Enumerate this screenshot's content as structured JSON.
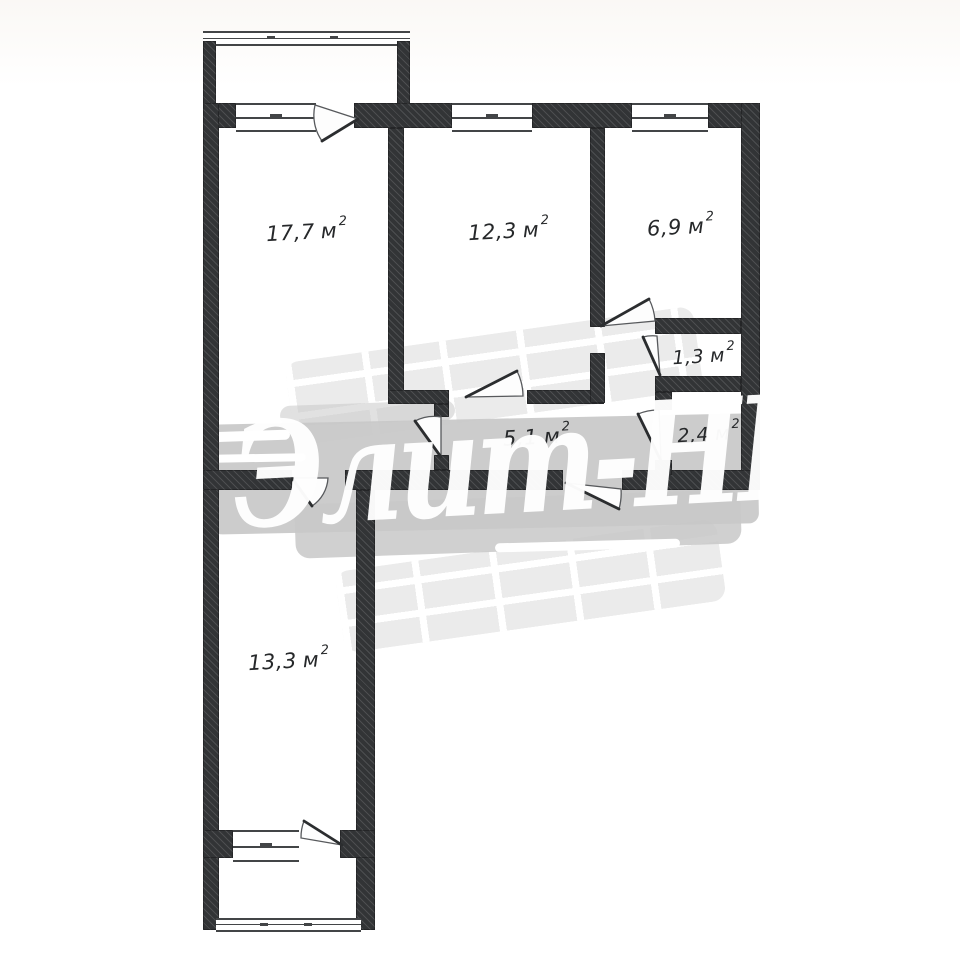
{
  "watermark": {
    "text": "Элит-НН"
  },
  "unit": {
    "base": "м",
    "sup": "2"
  },
  "rooms": [
    {
      "id": "room-17-7",
      "area": "17,7"
    },
    {
      "id": "room-12-3",
      "area": "12,3"
    },
    {
      "id": "room-6-9",
      "area": "6,9"
    },
    {
      "id": "room-1-3",
      "area": "1,3"
    },
    {
      "id": "room-2-4",
      "area": "2,4"
    },
    {
      "id": "hall-5-1",
      "area": "5,1"
    },
    {
      "id": "room-13-3",
      "area": "13,3"
    }
  ]
}
